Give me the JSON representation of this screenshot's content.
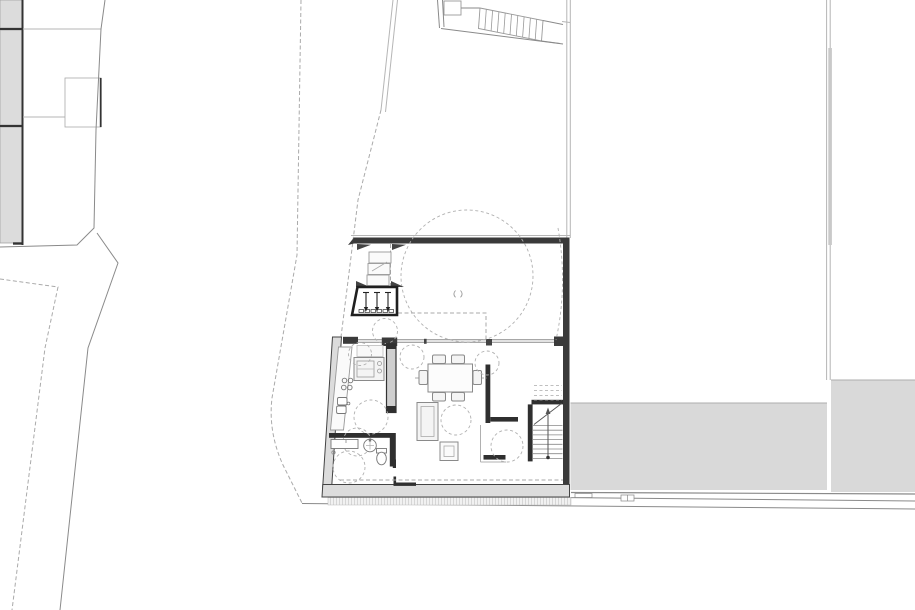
{
  "document": {
    "type": "architectural-floor-plan",
    "view": "ground-floor plan with site context",
    "visible_text": []
  },
  "colors": {
    "paper": "#ffffff",
    "wall_dark": "#3a3a3a",
    "wall_medium": "#2f2f2f",
    "wall_fill": "#dcdcdc",
    "pavement_fill": "#d9d9d9",
    "line_light": "#b5b5b5",
    "line_mid": "#8a8a8a",
    "dash_line": "#aaaaaa",
    "furniture_stroke": "#8a8a8a",
    "furniture_fill": "#f4f4f4",
    "accent_black": "#1f1f1f"
  },
  "site": {
    "adjacent_building_blocks": 3,
    "annex_block": 1,
    "street_lines": 2,
    "boundary_dashed_lines": 3,
    "external_stair_treads": 9,
    "pavement_areas": 2
  },
  "house": {
    "rooms": [
      "courtyard",
      "kitchen",
      "dining-living",
      "bathroom",
      "hall",
      "staircase"
    ],
    "entry_steps_arrows": 3,
    "main_stair_treads": 8,
    "dining_chairs": 6,
    "cooktop_burners": 4,
    "turning_circle_radius_px": 66
  }
}
